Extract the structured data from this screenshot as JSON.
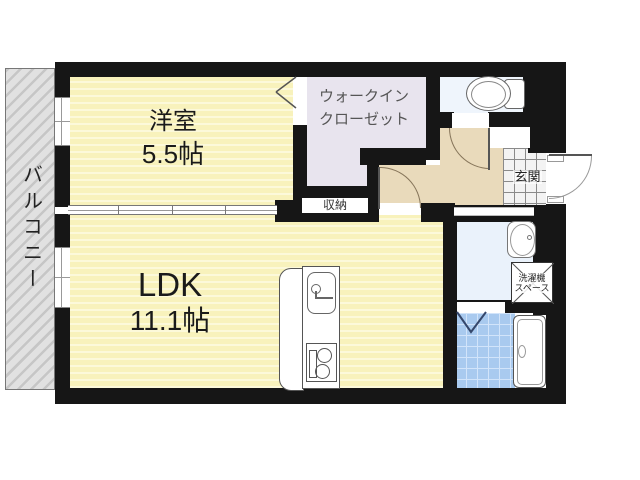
{
  "rooms": {
    "balcony": {
      "label": "バルコニー"
    },
    "western": {
      "name": "洋室",
      "size": "5.5帖"
    },
    "ldk": {
      "name": "LDK",
      "size": "11.1帖"
    },
    "wic": {
      "line1": "ウォークイン",
      "line2": "クローゼット"
    },
    "storage": {
      "label": "収納"
    },
    "entrance": {
      "label": "玄関"
    },
    "washer": {
      "line1": "洗濯機",
      "line2": "スペース"
    }
  },
  "fixtures": {
    "toilet": "toilet-icon",
    "bathtub": "bathtub-icon",
    "washbasin": "washbasin-icon",
    "kitchen_sink": "kitchen-sink-icon",
    "stove": "stove-icon",
    "washer_space": "washing-machine-space-box",
    "bath_door": "folding-door-icon",
    "entry_door": "entry-door-arc"
  },
  "colors": {
    "wall": "#161616",
    "room_yellow": "#f8f2bc",
    "room_yellow_stripe": "#fcf9da",
    "closet_lavender": "#e8e4ee",
    "hall_beige": "#e9dabb",
    "bath_tile_blue": "#a9caef",
    "washroom_blue": "#eaf2fb",
    "toilet_floor": "#eff5fc",
    "balcony_gray": "#d2d2d2"
  }
}
